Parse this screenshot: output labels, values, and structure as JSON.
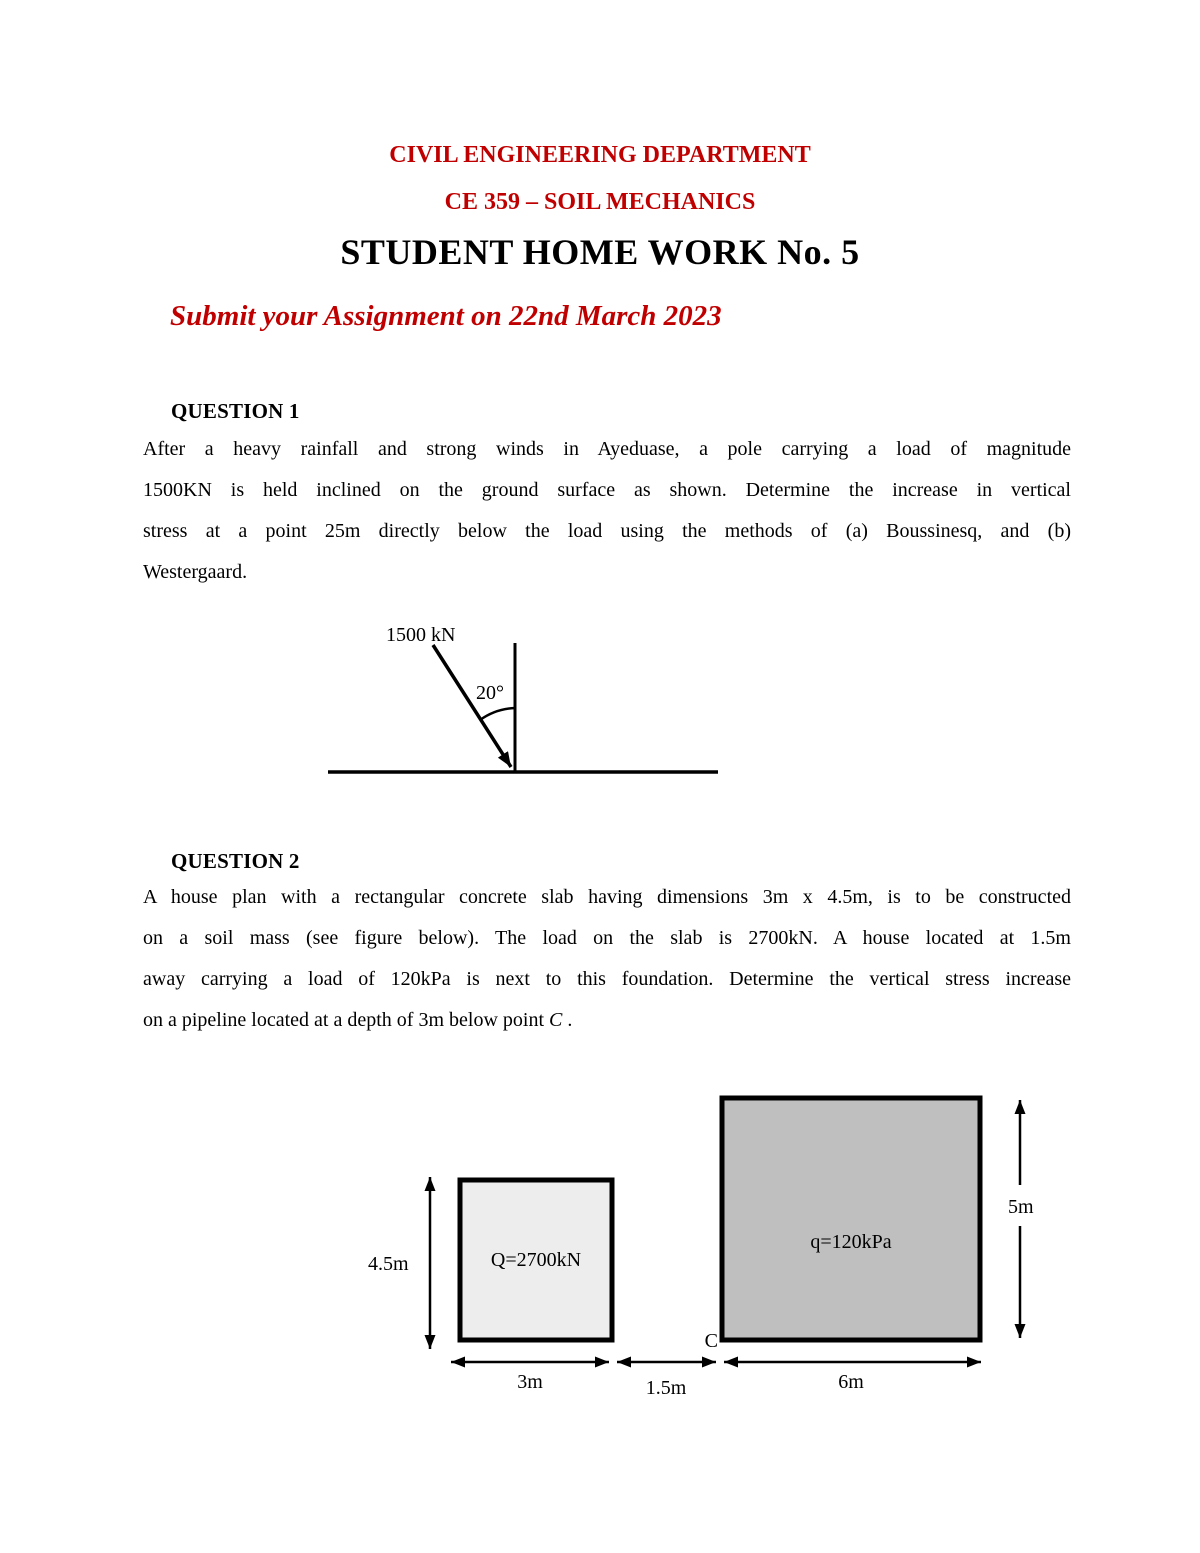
{
  "header": {
    "department": "CIVIL ENGINEERING DEPARTMENT",
    "course": "CE 359 – SOIL MECHANICS",
    "title": "STUDENT HOME WORK No. 5",
    "submit_note": "Submit your Assignment on 22nd March 2023",
    "accent_red": "#C00000"
  },
  "question1": {
    "heading": "QUESTION 1",
    "lines": [
      "After a heavy rainfall and strong winds in Ayeduase, a pole carrying a load of magnitude",
      "1500KN is held inclined on the ground surface as shown. Determine the increase in vertical",
      "stress at a point 25m directly below the load using the methods of (a) Boussinesq, and (b)"
    ],
    "last_line": "Westergaard.",
    "figure": {
      "load_label": "1500 kN",
      "angle_label": "20°"
    }
  },
  "question2": {
    "heading": "QUESTION 2",
    "lines": [
      "A house plan with a rectangular concrete slab having dimensions 3m x 4.5m, is to be constructed",
      "on a soil mass (see figure below). The load on the slab is 2700kN. A house located at 1.5m",
      "away carrying a load of 120kPa is next to this foundation. Determine the vertical stress increase"
    ],
    "last_line_prefix": "on a pipeline located at a depth of 3m below point ",
    "last_line_italic": "C",
    "last_line_suffix": " .",
    "figure": {
      "slab_label": "Q=2700kN",
      "house_label": "q=120kPa",
      "point_label": "C",
      "dim_left": "4.5m",
      "dim_right": "5m",
      "dim_bottom_left": "3m",
      "dim_bottom_mid": "1.5m",
      "dim_bottom_right": "6m",
      "slab_fill": "#ededed",
      "house_fill": "#bfbfbf"
    }
  }
}
